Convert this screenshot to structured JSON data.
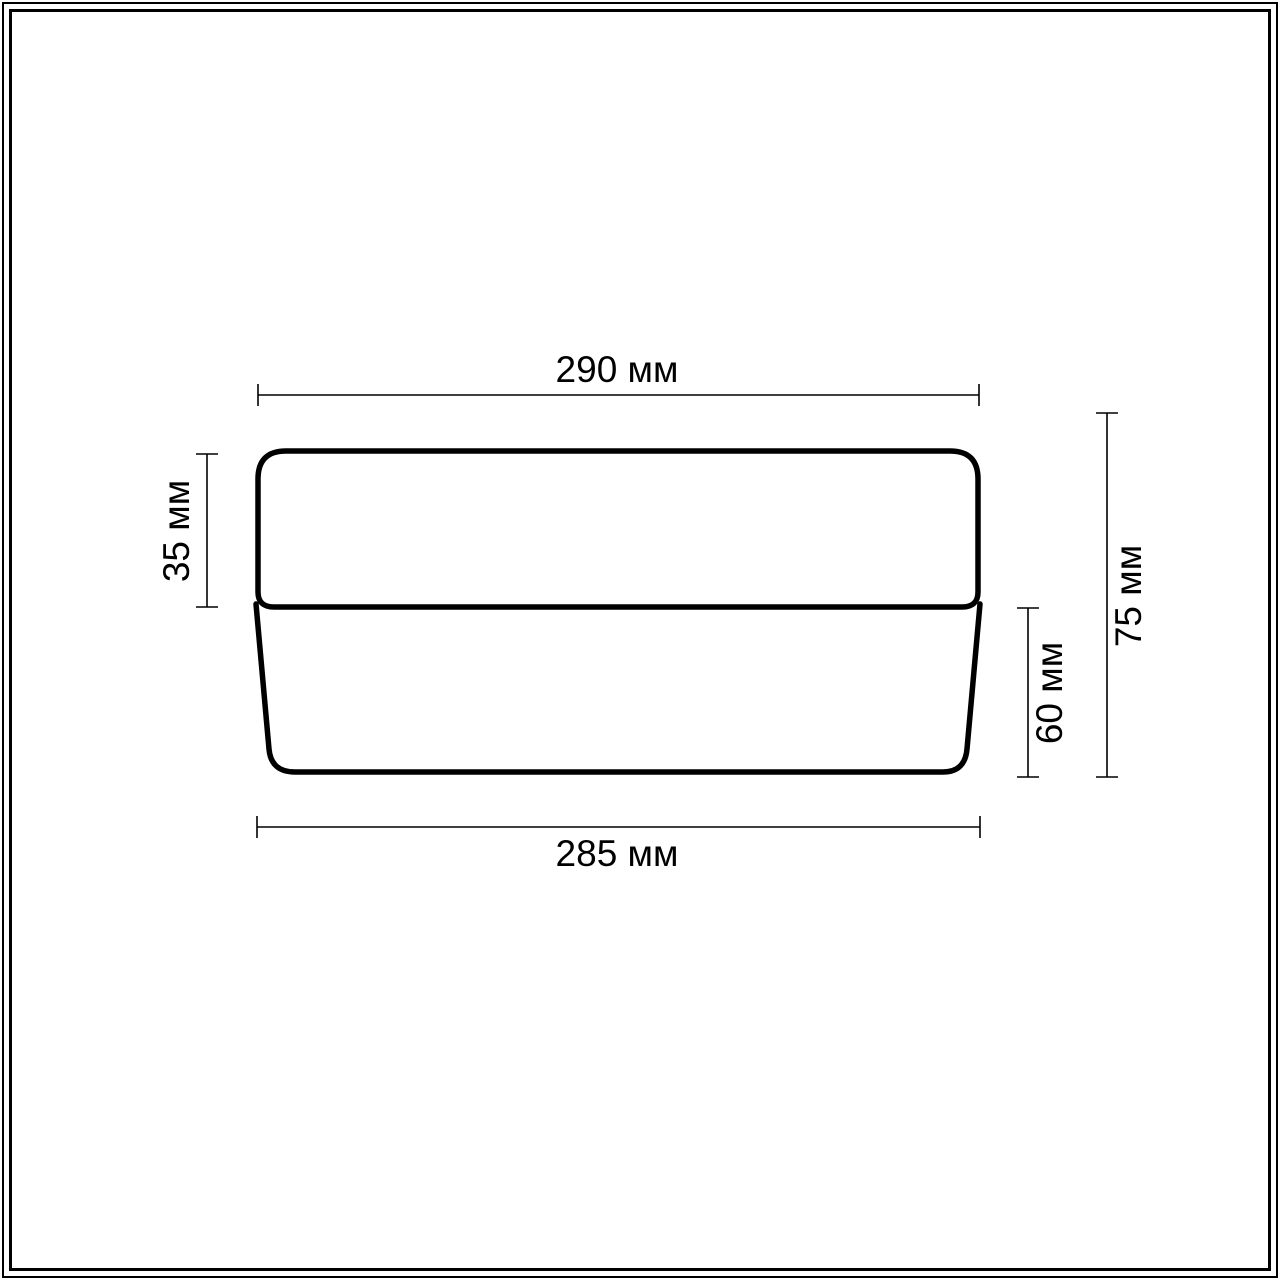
{
  "diagram": {
    "title": "fixture-dimension-drawing",
    "units": "мм",
    "labels": {
      "top_width": "290 мм",
      "bottom_width": "285 мм",
      "upper_height": "35 мм",
      "lower_height": "60 мм",
      "total_height": "75 мм"
    },
    "dimensions_mm": {
      "top_width": 290,
      "bottom_width": 285,
      "upper_height": 35,
      "lower_height": 60,
      "total_height": 75
    },
    "colors": {
      "line": "#000000",
      "background": "#ffffff",
      "outline_stroke_px": 5.5,
      "dimension_stroke_px": 1.6
    }
  }
}
